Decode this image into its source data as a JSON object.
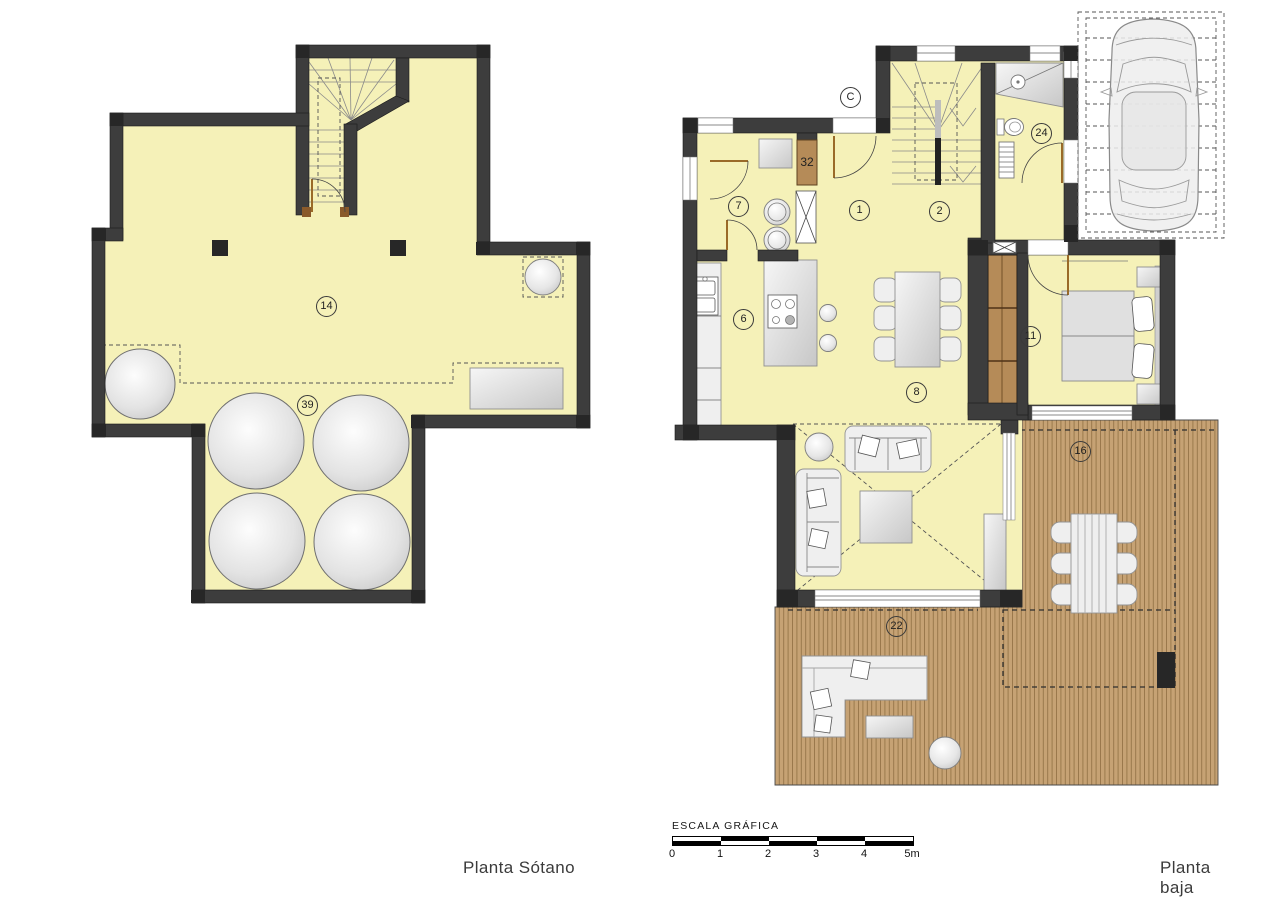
{
  "colors": {
    "wall": "#3d3d3d",
    "room": "#f5f1b8",
    "deck": "#c6a274",
    "deckline": "#8f6f42",
    "wardrobe": "#b58b58",
    "door": "#9a6a28",
    "dash": "#555555"
  },
  "basement": {
    "title": "Planta Sótano",
    "labels": [
      {
        "text": "14",
        "x": 327,
        "y": 307
      },
      {
        "text": "39",
        "x": 308,
        "y": 406
      }
    ]
  },
  "ground_floor": {
    "title": "Planta baja",
    "labels": [
      {
        "text": "C",
        "x": 851,
        "y": 98
      },
      {
        "text": "1",
        "x": 860,
        "y": 211
      },
      {
        "text": "2",
        "x": 940,
        "y": 212
      },
      {
        "text": "24",
        "x": 1042,
        "y": 134
      },
      {
        "text": "7",
        "x": 739,
        "y": 207
      },
      {
        "text": "6",
        "x": 744,
        "y": 320
      },
      {
        "text": "8",
        "x": 917,
        "y": 393
      },
      {
        "text": "11",
        "x": 1031,
        "y": 337
      },
      {
        "text": "16",
        "x": 1081,
        "y": 452
      },
      {
        "text": "22",
        "x": 897,
        "y": 627
      }
    ],
    "tag_32": {
      "text": "32",
      "x": 807,
      "y": 162
    }
  },
  "scale_bar": {
    "title": "ESCALA GRÁFICA",
    "unit_labels": [
      "0",
      "1",
      "2",
      "3",
      "4",
      "5m"
    ]
  },
  "titles": {
    "basement_x": 519,
    "basement_y": 858,
    "ground_x": 1200,
    "ground_y": 858
  }
}
